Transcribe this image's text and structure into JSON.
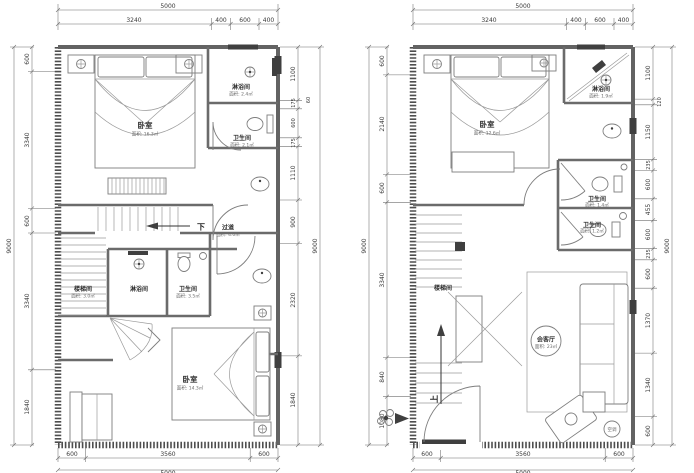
{
  "plans": [
    {
      "side": "left-plan-upper-floor",
      "dims": {
        "top": {
          "overall": "5000",
          "segs": [
            "3240",
            "400",
            "600",
            "400"
          ]
        },
        "left": {
          "overall": "9000",
          "segs": [
            "600",
            "3340",
            "600",
            "3340",
            "1840"
          ]
        },
        "right": {
          "overall": "9000",
          "note": "60",
          "segs": [
            "1100",
            "175",
            "600",
            "175",
            "1110",
            "900",
            "2320",
            "1840"
          ]
        },
        "bottom": {
          "overall": "5000",
          "segs": [
            "600",
            "3560",
            "600"
          ]
        }
      },
      "rooms": {
        "bedroom_top": {
          "label": "卧室",
          "area": "面积: 16.3㎡"
        },
        "shower_top": {
          "label": "淋浴间",
          "area": "面积: 2.4㎡"
        },
        "toilet_top": {
          "label": "卫生间",
          "area": "面积: 2.1㎡"
        },
        "corridor": {
          "label": "过道",
          "area": "面积: 4.0㎡"
        },
        "stairwell": {
          "label": "楼梯间",
          "area": "面积: 3.0㎡"
        },
        "shower_mid": {
          "label": "淋浴间"
        },
        "toilet_mid": {
          "label": "卫生间",
          "area": "面积: 3.5㎡"
        },
        "bedroom_bottom": {
          "label": "卧室",
          "area": "面积: 14.3㎡"
        }
      },
      "annotations": {
        "down": "下"
      }
    },
    {
      "side": "right-plan-ground-floor",
      "dims": {
        "top": {
          "overall": "5000",
          "segs": [
            "3240",
            "400",
            "600",
            "400"
          ]
        },
        "left": {
          "overall": "9000",
          "segs": [
            "600",
            "2140",
            "600",
            "3340",
            "840",
            "1080"
          ]
        },
        "right": {
          "overall": "9000",
          "note": "120",
          "segs": [
            "1100",
            "1150",
            "235",
            "600",
            "455",
            "600",
            "235",
            "600",
            "1370",
            "1340",
            "600"
          ]
        },
        "bottom": {
          "overall": "5000",
          "segs": [
            "600",
            "3560",
            "600"
          ]
        }
      },
      "rooms": {
        "bedroom_top": {
          "label": "卧室",
          "area": "面积: 12.6㎡"
        },
        "shower_top": {
          "label": "淋浴间",
          "area": "面积: 1.9㎡"
        },
        "toilet_1": {
          "label": "卫生间",
          "area": "面积: 1.4㎡"
        },
        "toilet_2": {
          "label": "卫生间",
          "area": "面积: 1.2㎡"
        },
        "stairwell": {
          "label": "楼梯间"
        },
        "living": {
          "label": "会客厅",
          "area": "面积: 23㎡"
        },
        "ac_unit": {
          "label": "空调"
        }
      },
      "annotations": {
        "up": "上"
      }
    }
  ]
}
